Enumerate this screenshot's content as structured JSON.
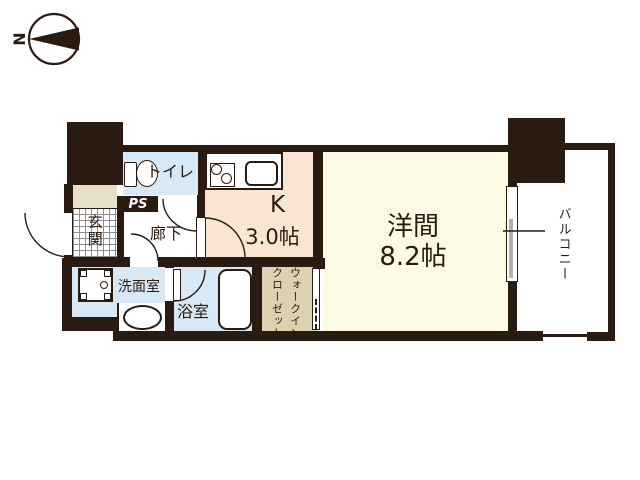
{
  "title": "1K apartment floor plan",
  "compass": {
    "letter": "N"
  },
  "rooms": {
    "toilet": {
      "label": "トイレ"
    },
    "pipe_space": {
      "label": "PS"
    },
    "entrance": {
      "label": "玄関"
    },
    "hallway": {
      "label": "廊下"
    },
    "kitchen": {
      "label": "K",
      "size": "3.0帖"
    },
    "main_room": {
      "label": "洋間",
      "size": "8.2帖"
    },
    "washroom": {
      "label": "洗面室"
    },
    "bathroom": {
      "label": "浴室"
    },
    "walk_in_closet": {
      "label_line1": "ウォークイン",
      "label_line2": "クローゼット"
    },
    "balcony": {
      "label": "バルコニー"
    }
  },
  "colors": {
    "wall": "#2a1b12",
    "wet_rooms_blue": "#d8e8f4",
    "kitchen_peach": "#fae4d2",
    "main_room_cream": "#fcf9e5",
    "closet_tan": "#dcd2b2",
    "entrance_step_beige": "#e7dfc7",
    "window_gray": "#b0b0b0",
    "background": "#ffffff"
  }
}
